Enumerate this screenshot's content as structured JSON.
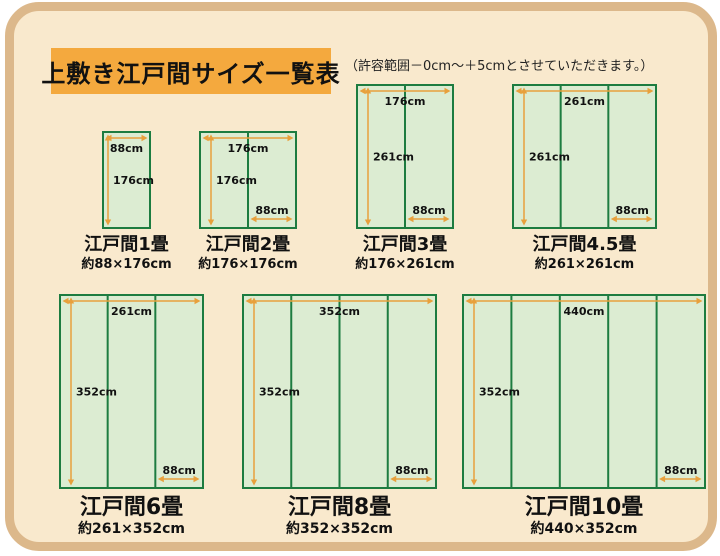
{
  "header": {
    "title": "上敷き江戸間サイズ一覧表",
    "note": "（許容範囲－0cm～＋5cmとさせていただきます。）"
  },
  "colors": {
    "panel_border": "#dcb88b",
    "panel_bg": "#f9e9cd",
    "title_bg": "#f4a93e",
    "mat_border": "#1d7c40",
    "mat_fill": "#dcecd2",
    "arrow": "#e8a03c",
    "text": "#111111"
  },
  "diagrams": [
    {
      "name": "江戸間1畳",
      "size": "約88×176cm",
      "width_cm": 88,
      "height_cm": 176,
      "mats_across": 1,
      "width_label": "88cm",
      "height_label": "176cm",
      "mat_width_label": ""
    },
    {
      "name": "江戸間2畳",
      "size": "約176×176cm",
      "width_cm": 176,
      "height_cm": 176,
      "mats_across": 2,
      "width_label": "176cm",
      "height_label": "176cm",
      "mat_width_label": "88cm"
    },
    {
      "name": "江戸間3畳",
      "size": "約176×261cm",
      "width_cm": 176,
      "height_cm": 261,
      "mats_across": 2,
      "width_label": "176cm",
      "height_label": "261cm",
      "mat_width_label": "88cm"
    },
    {
      "name": "江戸間4.5畳",
      "size": "約261×261cm",
      "width_cm": 261,
      "height_cm": 261,
      "mats_across": 3,
      "width_label": "261cm",
      "height_label": "261cm",
      "mat_width_label": "88cm"
    },
    {
      "name": "江戸間6畳",
      "size": "約261×352cm",
      "width_cm": 261,
      "height_cm": 352,
      "mats_across": 3,
      "width_label": "261cm",
      "height_label": "352cm",
      "mat_width_label": "88cm"
    },
    {
      "name": "江戸間8畳",
      "size": "約352×352cm",
      "width_cm": 352,
      "height_cm": 352,
      "mats_across": 4,
      "width_label": "352cm",
      "height_label": "352cm",
      "mat_width_label": "88cm"
    },
    {
      "name": "江戸間10畳",
      "size": "約440×352cm",
      "width_cm": 440,
      "height_cm": 352,
      "mats_across": 5,
      "width_label": "440cm",
      "height_label": "352cm",
      "mat_width_label": "88cm"
    }
  ]
}
